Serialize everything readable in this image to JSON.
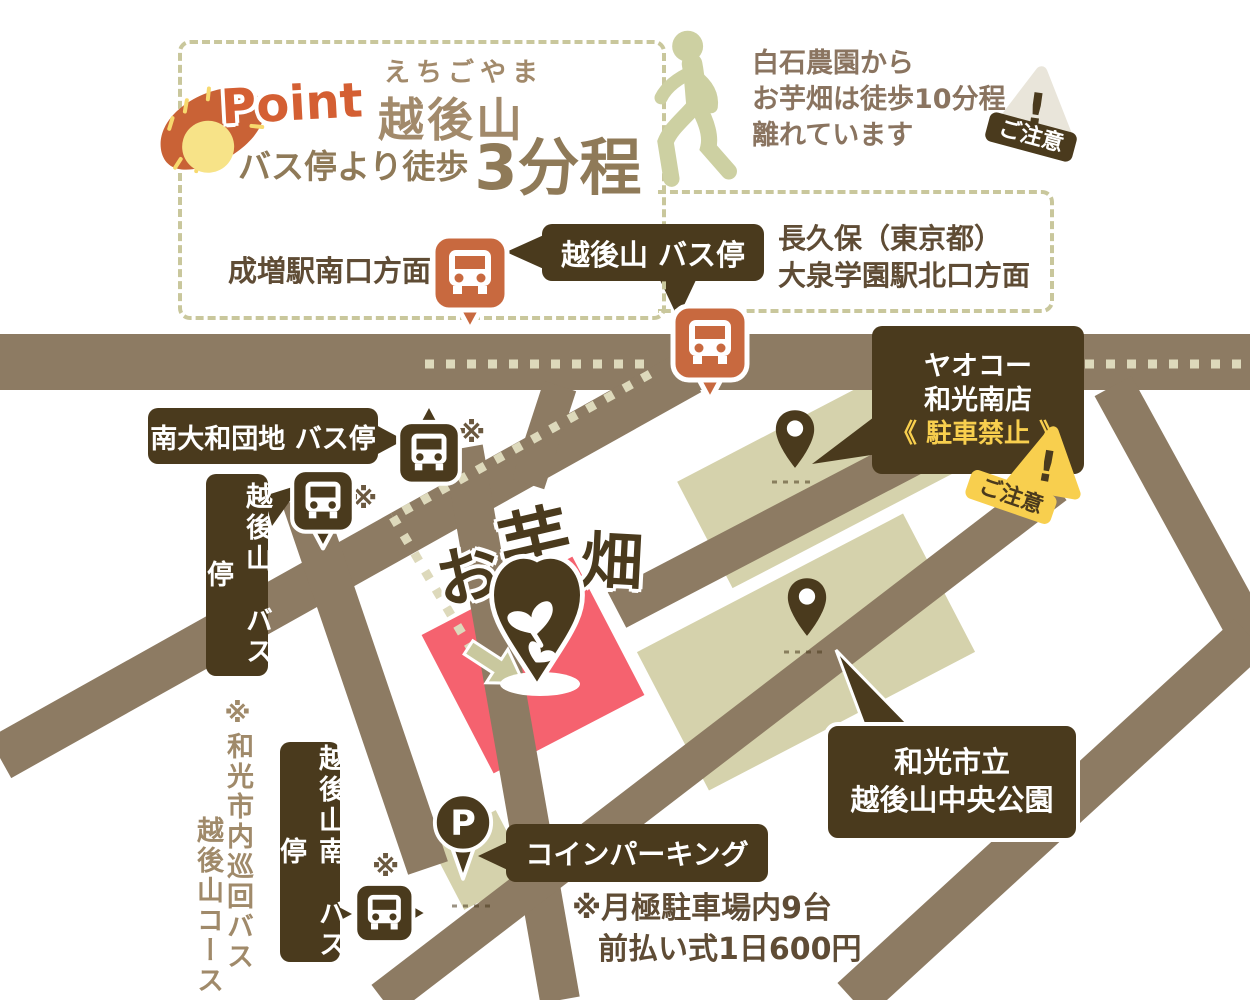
{
  "point_box": {
    "label": "Point",
    "furigana": "えちごやま",
    "stop_name": "越後山",
    "walk_prefix": "バス停より徒歩",
    "walk_time": "3分程"
  },
  "walk_note": {
    "lines": [
      "白石農園から",
      "お芋畑は徒歩10分程",
      "離れています"
    ]
  },
  "caution": {
    "label": "ご注意",
    "exclamation": "!"
  },
  "directions": {
    "narimasu": "成増駅南口方面",
    "nagakubo_line1": "長久保（東京都）",
    "nagakubo_line2": "大泉学園駅北口方面"
  },
  "bus_stops": {
    "echigoyama_top": "越後山 バス停",
    "minami_yamato": "南大和団地  バス停",
    "echigoyama_vertical": "越後山　バス停",
    "echigoyama_minami": "越後山南　バス停"
  },
  "yaoko": {
    "line1": "ヤオコー",
    "line2": "和光南店",
    "parking_ban": "《 駐車禁止 》"
  },
  "park": {
    "line1": "和光市立",
    "line2": "越後山中央公園"
  },
  "field": {
    "name": "お芋畑",
    "chars": [
      "お",
      "芋",
      "畑"
    ]
  },
  "parking": {
    "label": "コインパーキング",
    "p_mark": "P",
    "note_line1": "※月極駐車場内9台",
    "note_line2": "前払い式1日600円"
  },
  "loop_bus_note": {
    "line1": "※和光市内巡回バス",
    "line2": "越後山コース"
  },
  "asterisk": "※",
  "colors": {
    "road": "#8d7b63",
    "dark_brown": "#4a3a1d",
    "orange": "#c8693f",
    "olive_block": "#d5d2ac",
    "olive_icon": "#cdd0a2",
    "field_red": "#f5626f",
    "yellow": "#f8cf4e",
    "route_dots": "#ddd9bb"
  }
}
